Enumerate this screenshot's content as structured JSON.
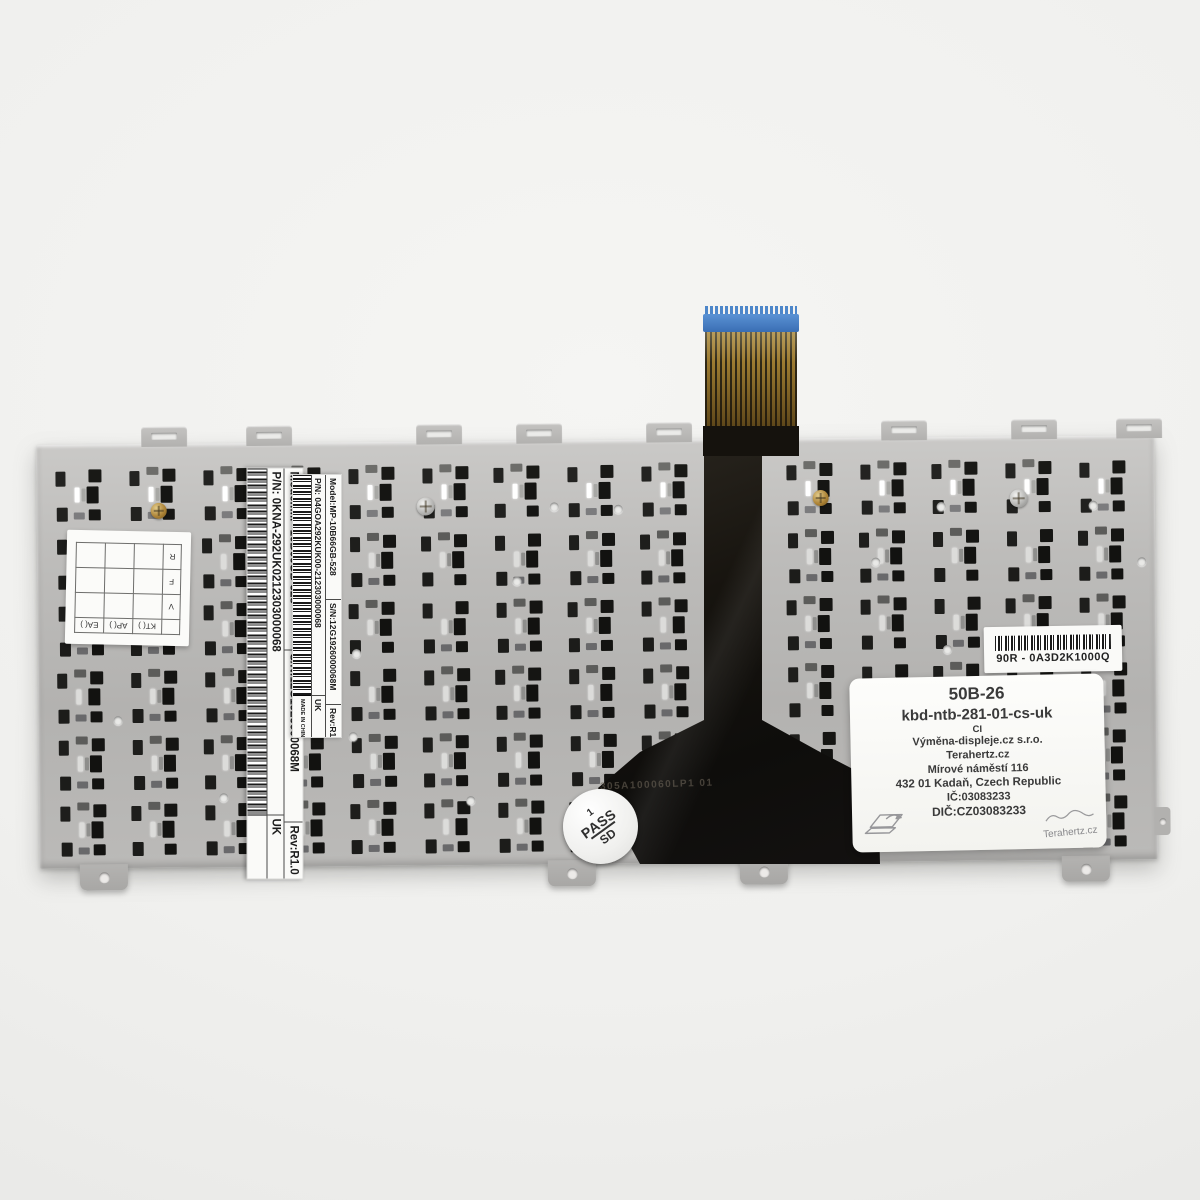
{
  "photo": {
    "description": "Rear side of a replacement laptop keyboard: metal backplate, flex ribbon cable and manufacturer / reseller labels"
  },
  "plate_markings": {
    "etched_code": "305A100060LP1 01"
  },
  "pass_sticker": {
    "line1": "1",
    "line2": "PASS",
    "line3": "SD"
  },
  "qc_grid_label": {
    "side_labels": [
      "R",
      "F",
      "V"
    ],
    "bottom_labels": [
      "EA( )",
      "AP( )",
      "KT( )"
    ]
  },
  "asus_label_large": {
    "model": "Model:MP-10B66GB-528",
    "serial": "S/N:12G1926000068M",
    "rev": "Rev:R1.0",
    "part_number": "P/N: 0KNA-292UK0212303000068",
    "layout_code": "UK"
  },
  "asus_label_small": {
    "model": "Model:MP-10B66GB-528",
    "serial": "S/N:12G1926000068M",
    "rev": "Rev:R1.0",
    "part_number": "P/N: 04GOA292KUK00-212303000068",
    "made_in": "MADE IN CHINA",
    "layout_code": "UK"
  },
  "sku_label": {
    "code": "90R - 0A3D2K1000Q"
  },
  "reseller_label": {
    "sku": "50B-26",
    "product_code": "kbd-ntb-281-01-cs-uk",
    "variant": "CI",
    "company": "Výměna-displeje.cz s.r.o.",
    "brand": "Terahertz.cz",
    "street": "Mírové náměstí 116",
    "city": "432 01 Kadaň, Czech Republic",
    "company_id": "IČ:03083233",
    "vat_id": "DIČ:CZ03083233",
    "signature": "Terahertz.cz"
  }
}
